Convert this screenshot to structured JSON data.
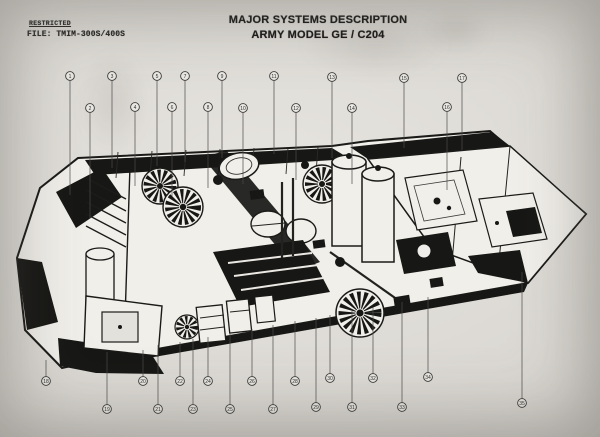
{
  "page": {
    "classification": "RESTRICTED",
    "file_number": "FILE: TMIM-300S/400S",
    "title_line1": "MAJOR SYSTEMS DESCRIPTION",
    "title_line2": "ARMY MODEL GE / C204"
  },
  "colors": {
    "paper": "#dad7d2",
    "ink": "#171715",
    "leader_line": "#4c4b49",
    "callout_fill": "#eae8e3",
    "callout_stroke": "#3d3d3b"
  },
  "figure": {
    "type": "isometric-cutaway-diagram",
    "subject": "Trailer van cutaway showing internal major systems with numbered callouts",
    "callouts": [
      {
        "n": 1,
        "x": 70,
        "y": 76,
        "ty": 195
      },
      {
        "n": 2,
        "x": 90,
        "y": 108,
        "ty": 218
      },
      {
        "n": 3,
        "x": 112,
        "y": 76,
        "ty": 168
      },
      {
        "n": 4,
        "x": 135,
        "y": 107,
        "ty": 186
      },
      {
        "n": 5,
        "x": 157,
        "y": 76,
        "ty": 166
      },
      {
        "n": 6,
        "x": 172,
        "y": 107,
        "ty": 196
      },
      {
        "n": 7,
        "x": 185,
        "y": 76,
        "ty": 162
      },
      {
        "n": 8,
        "x": 208,
        "y": 107,
        "ty": 188
      },
      {
        "n": 9,
        "x": 222,
        "y": 76,
        "ty": 158
      },
      {
        "n": 10,
        "x": 243,
        "y": 108,
        "ty": 184
      },
      {
        "n": 11,
        "x": 274,
        "y": 76,
        "ty": 154
      },
      {
        "n": 12,
        "x": 296,
        "y": 108,
        "ty": 180
      },
      {
        "n": 13,
        "x": 332,
        "y": 77,
        "ty": 158
      },
      {
        "n": 14,
        "x": 352,
        "y": 108,
        "ty": 184
      },
      {
        "n": 15,
        "x": 404,
        "y": 78,
        "ty": 148
      },
      {
        "n": 16,
        "x": 447,
        "y": 107,
        "ty": 190
      },
      {
        "n": 17,
        "x": 462,
        "y": 78,
        "ty": 150
      },
      {
        "n": 18,
        "x": 46,
        "y": 381,
        "ty": 360
      },
      {
        "n": 19,
        "x": 107,
        "y": 409,
        "ty": 352
      },
      {
        "n": 20,
        "x": 143,
        "y": 381,
        "ty": 350
      },
      {
        "n": 21,
        "x": 158,
        "y": 409,
        "ty": 345
      },
      {
        "n": 22,
        "x": 180,
        "y": 381,
        "ty": 342
      },
      {
        "n": 23,
        "x": 193,
        "y": 409,
        "ty": 339
      },
      {
        "n": 24,
        "x": 208,
        "y": 381,
        "ty": 337
      },
      {
        "n": 25,
        "x": 230,
        "y": 409,
        "ty": 333
      },
      {
        "n": 26,
        "x": 252,
        "y": 381,
        "ty": 329
      },
      {
        "n": 27,
        "x": 273,
        "y": 409,
        "ty": 325
      },
      {
        "n": 28,
        "x": 295,
        "y": 381,
        "ty": 321
      },
      {
        "n": 29,
        "x": 316,
        "y": 407,
        "ty": 318
      },
      {
        "n": 30,
        "x": 330,
        "y": 378,
        "ty": 315
      },
      {
        "n": 31,
        "x": 352,
        "y": 407,
        "ty": 311
      },
      {
        "n": 32,
        "x": 373,
        "y": 378,
        "ty": 307
      },
      {
        "n": 33,
        "x": 402,
        "y": 407,
        "ty": 302
      },
      {
        "n": 34,
        "x": 428,
        "y": 377,
        "ty": 297
      },
      {
        "n": 35,
        "x": 522,
        "y": 403,
        "ty": 272
      }
    ]
  }
}
